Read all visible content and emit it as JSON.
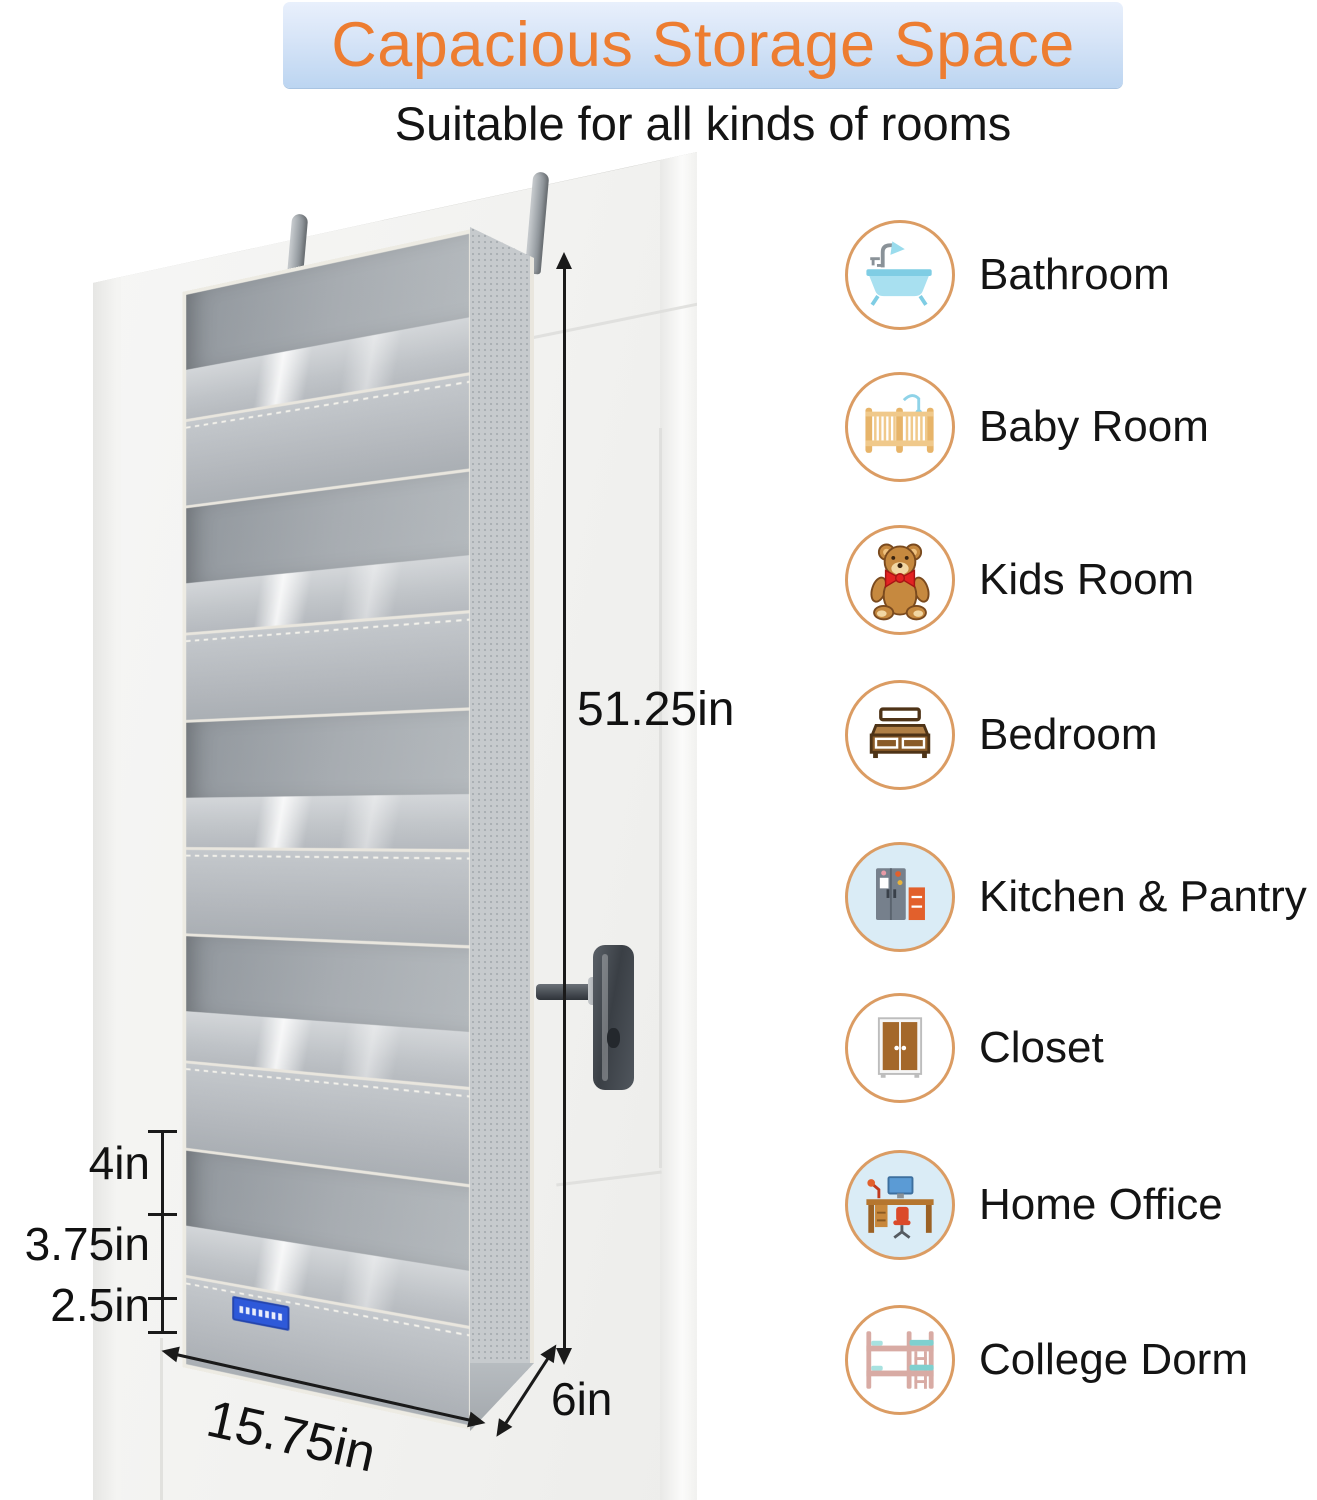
{
  "banner": {
    "title": "Capacious Storage Space"
  },
  "subtitle": "Suitable for all kinds of rooms",
  "dimensions": {
    "height": "51.25in",
    "width": "15.75in",
    "depth": "6in",
    "pocket_depths": [
      "4in",
      "3.75in",
      "2.5in"
    ]
  },
  "rooms": {
    "items": [
      {
        "label": "Bathroom",
        "icon": "bathtub-icon"
      },
      {
        "label": "Baby Room",
        "icon": "crib-icon"
      },
      {
        "label": "Kids Room",
        "icon": "teddy-bear-icon"
      },
      {
        "label": "Bedroom",
        "icon": "bed-icon"
      },
      {
        "label": "Kitchen & Pantry",
        "icon": "fridge-icon"
      },
      {
        "label": "Closet",
        "icon": "wardrobe-icon"
      },
      {
        "label": "Home Office",
        "icon": "desk-icon"
      },
      {
        "label": "College Dorm",
        "icon": "bunk-bed-icon"
      }
    ]
  },
  "colors": {
    "accent_orange": "#ED7D31",
    "banner_blue_top": "#e9f0fc",
    "banner_blue_bottom": "#bcd5f1",
    "circle_outline": "#db9c63",
    "brand_tag_blue": "#2e59d9",
    "organizer_gray": "#b3b7bc"
  }
}
